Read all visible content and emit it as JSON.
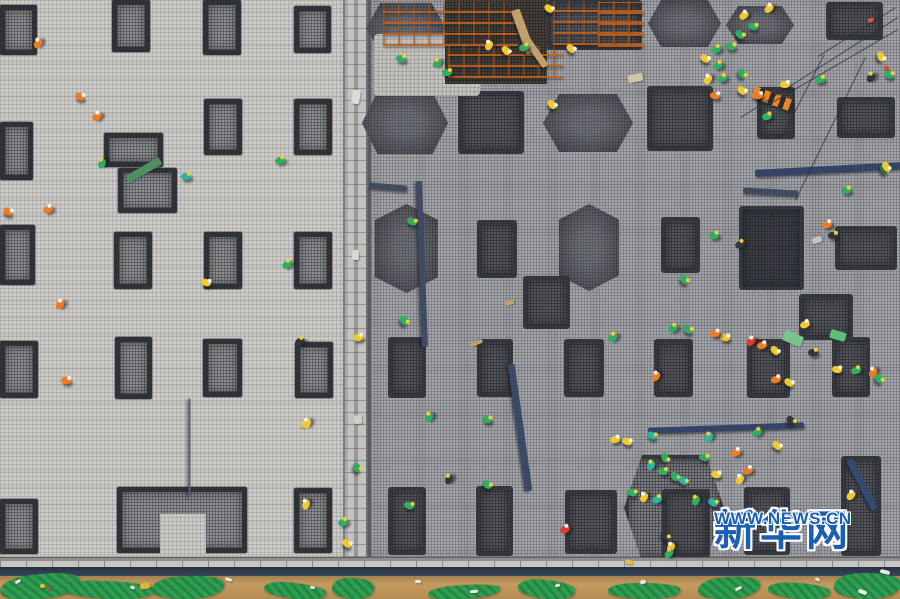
{
  "watermark": {
    "brand": "新华网",
    "url": "WWW.NEWS.CN",
    "color": "#1b5fb5"
  },
  "palette": {
    "slab_left": "#cbcac6",
    "slab_right": "#a4a5a9",
    "footing_dark": "#33363c",
    "rebar_orange": "#be5f1e",
    "steel_blue": "#3a4a66",
    "dirt": "#c59a5f",
    "tarp_green": "#2e9e50",
    "vest_green": "#2fae62",
    "vest_yellow": "#efc92e",
    "vest_orange": "#ef7b22",
    "vest_red": "#d9402a"
  },
  "left_slab": {
    "footings": [
      [
        0,
        5,
        37,
        50
      ],
      [
        112,
        0,
        38,
        52
      ],
      [
        203,
        0,
        38,
        55
      ],
      [
        294,
        6,
        37,
        47
      ],
      [
        0,
        122,
        33,
        58
      ],
      [
        204,
        99,
        38,
        56
      ],
      [
        294,
        99,
        38,
        56
      ],
      [
        104,
        133,
        59,
        34
      ],
      [
        118,
        168,
        59,
        45
      ],
      [
        0,
        225,
        35,
        60
      ],
      [
        114,
        232,
        38,
        57
      ],
      [
        204,
        232,
        38,
        57
      ],
      [
        294,
        232,
        38,
        57
      ],
      [
        0,
        341,
        38,
        57
      ],
      [
        115,
        337,
        37,
        62
      ],
      [
        203,
        339,
        39,
        58
      ],
      [
        295,
        342,
        38,
        56
      ],
      [
        0,
        499,
        38,
        55
      ],
      [
        117,
        487,
        130,
        66
      ],
      [
        294,
        488,
        38,
        65
      ]
    ],
    "patches": [
      [
        160,
        514,
        46,
        40
      ]
    ]
  },
  "right_slab": {
    "footings": [
      [
        366,
        3,
        80,
        50,
        "h"
      ],
      [
        362,
        92,
        86,
        62,
        "h"
      ],
      [
        543,
        94,
        90,
        58,
        "h"
      ],
      [
        648,
        0,
        73,
        47,
        "h"
      ],
      [
        726,
        6,
        68,
        38,
        "h"
      ],
      [
        375,
        204,
        63,
        89,
        "v"
      ],
      [
        559,
        204,
        60,
        87,
        "v"
      ],
      [
        624,
        455,
        100,
        106,
        "halo"
      ],
      [
        546,
        0,
        96,
        50,
        "r"
      ],
      [
        826,
        2,
        57,
        38,
        "r"
      ],
      [
        757,
        87,
        38,
        52,
        "r"
      ],
      [
        837,
        97,
        58,
        41,
        "r"
      ],
      [
        458,
        91,
        66,
        63,
        "d"
      ],
      [
        647,
        86,
        66,
        65,
        "d"
      ],
      [
        477,
        220,
        40,
        58,
        "r"
      ],
      [
        661,
        217,
        39,
        56,
        "r"
      ],
      [
        739,
        206,
        65,
        84,
        "b"
      ],
      [
        835,
        226,
        62,
        44,
        "r"
      ],
      [
        799,
        294,
        54,
        46,
        "r"
      ],
      [
        523,
        276,
        47,
        53,
        "w"
      ],
      [
        388,
        337,
        38,
        61,
        "r"
      ],
      [
        477,
        339,
        36,
        58,
        "r"
      ],
      [
        564,
        339,
        40,
        58,
        "r"
      ],
      [
        654,
        339,
        39,
        58,
        "r"
      ],
      [
        747,
        339,
        43,
        59,
        "r"
      ],
      [
        832,
        337,
        38,
        60,
        "r"
      ],
      [
        388,
        487,
        38,
        68,
        "r"
      ],
      [
        476,
        486,
        37,
        70,
        "r"
      ],
      [
        565,
        490,
        52,
        64,
        "r"
      ],
      [
        662,
        489,
        48,
        69,
        "r"
      ],
      [
        744,
        487,
        46,
        68,
        "r"
      ],
      [
        841,
        456,
        40,
        100,
        "r"
      ]
    ],
    "patches": [
      [
        374,
        34,
        106,
        62
      ]
    ],
    "pit": [
      445,
      0,
      102,
      84
    ],
    "scaffolds": [
      [
        383,
        2,
        135,
        44
      ],
      [
        448,
        46,
        115,
        32
      ],
      [
        553,
        1,
        90,
        44
      ],
      [
        598,
        2,
        45,
        45
      ]
    ]
  },
  "beams": [
    [
      422,
      264,
      166,
      6,
      88,
      "#3e4a66"
    ],
    [
      520,
      427,
      128,
      7,
      82,
      "#3a4a66"
    ],
    [
      726,
      428,
      156,
      6,
      -2,
      "#354466"
    ],
    [
      828,
      169,
      146,
      7,
      -3,
      "#354466"
    ],
    [
      388,
      187,
      38,
      6,
      5,
      "#414b5e"
    ],
    [
      770,
      192,
      55,
      6,
      3,
      "#414b5e"
    ],
    [
      862,
      484,
      56,
      7,
      63,
      "#354a70"
    ],
    [
      523,
      31,
      46,
      9,
      70,
      "#c2a06b"
    ],
    [
      536,
      52,
      34,
      7,
      55,
      "#c2a06b"
    ],
    [
      189,
      448,
      99,
      2,
      90,
      "#596074"
    ]
  ],
  "cables": [
    [
      898,
      18,
      741,
      118
    ],
    [
      898,
      30,
      757,
      112
    ],
    [
      896,
      8,
      818,
      57
    ],
    [
      795,
      200,
      865,
      57
    ],
    [
      782,
      136,
      824,
      54
    ]
  ],
  "lift_beam": [
    752,
    93,
    42,
    12,
    20,
    "#e88820"
  ],
  "workers": [
    [
      33,
      40,
      "#ef7b22"
    ],
    [
      75,
      93,
      "#ef7b22"
    ],
    [
      92,
      113,
      "#ef7b22"
    ],
    [
      97,
      160,
      "#2fae62"
    ],
    [
      181,
      173,
      "#2ab5a0"
    ],
    [
      275,
      157,
      "#2fae62"
    ],
    [
      3,
      208,
      "#ef7b22"
    ],
    [
      43,
      206,
      "#ef7b22"
    ],
    [
      282,
      261,
      "#2fae62"
    ],
    [
      201,
      279,
      "#efc92e"
    ],
    [
      55,
      301,
      "#ef7b22"
    ],
    [
      61,
      377,
      "#ef7b22"
    ],
    [
      295,
      338,
      "#32353c"
    ],
    [
      302,
      420,
      "#efc92e"
    ],
    [
      301,
      501,
      "#efc92e"
    ],
    [
      338,
      519,
      "#2fae62"
    ],
    [
      342,
      540,
      "#efc92e"
    ],
    [
      353,
      334,
      "#efc92e"
    ],
    [
      352,
      464,
      "#2fae62"
    ],
    [
      396,
      55,
      "#2fae62"
    ],
    [
      432,
      60,
      "#2fae62"
    ],
    [
      442,
      69,
      "#2fae62"
    ],
    [
      484,
      42,
      "#efc92e"
    ],
    [
      501,
      47,
      "#efc92e"
    ],
    [
      519,
      44,
      "#2fae62"
    ],
    [
      544,
      5,
      "#efc92e"
    ],
    [
      566,
      45,
      "#efc92e"
    ],
    [
      547,
      101,
      "#efc92e"
    ],
    [
      407,
      218,
      "#2fae62"
    ],
    [
      739,
      12,
      "#efc92e"
    ],
    [
      748,
      23,
      "#2fae62"
    ],
    [
      735,
      31,
      "#2fae62"
    ],
    [
      711,
      46,
      "#2fae62"
    ],
    [
      700,
      55,
      "#efc92e"
    ],
    [
      726,
      43,
      "#2fae62"
    ],
    [
      713,
      62,
      "#2fae62"
    ],
    [
      737,
      70,
      "#2fae62"
    ],
    [
      703,
      76,
      "#efc92e"
    ],
    [
      764,
      5,
      "#efc92e"
    ],
    [
      717,
      75,
      "#2fae62"
    ],
    [
      710,
      92,
      "#ef7b22"
    ],
    [
      753,
      92,
      "#ef7b22"
    ],
    [
      815,
      76,
      "#2fae62"
    ],
    [
      876,
      53,
      "#efc92e"
    ],
    [
      866,
      74,
      "#32353c"
    ],
    [
      884,
      71,
      "#2fae62"
    ],
    [
      780,
      81,
      "#efc92e"
    ],
    [
      737,
      87,
      "#efc92e"
    ],
    [
      762,
      113,
      "#2fae62"
    ],
    [
      709,
      232,
      "#2fae62"
    ],
    [
      735,
      241,
      "#32353c"
    ],
    [
      822,
      221,
      "#ef7b22"
    ],
    [
      828,
      232,
      "#32353c"
    ],
    [
      679,
      276,
      "#2fae62"
    ],
    [
      683,
      326,
      "#2fae62"
    ],
    [
      720,
      334,
      "#efc92e"
    ],
    [
      746,
      338,
      "#d9402a"
    ],
    [
      757,
      342,
      "#ef7b22"
    ],
    [
      800,
      321,
      "#efc92e"
    ],
    [
      868,
      369,
      "#ef7b22"
    ],
    [
      874,
      375,
      "#2fae62"
    ],
    [
      784,
      379,
      "#efc92e"
    ],
    [
      651,
      373,
      "#ef7b22"
    ],
    [
      608,
      334,
      "#2fae62"
    ],
    [
      668,
      325,
      "#2fae62"
    ],
    [
      710,
      330,
      "#ef7b22"
    ],
    [
      770,
      347,
      "#efc92e"
    ],
    [
      808,
      349,
      "#32353c"
    ],
    [
      832,
      366,
      "#efc92e"
    ],
    [
      851,
      367,
      "#2fae62"
    ],
    [
      771,
      376,
      "#ef7b22"
    ],
    [
      786,
      417,
      "#32353c"
    ],
    [
      752,
      429,
      "#2fae62"
    ],
    [
      704,
      434,
      "#2ab5a0"
    ],
    [
      660,
      454,
      "#2fae62"
    ],
    [
      646,
      462,
      "#2ab5a0"
    ],
    [
      670,
      473,
      "#2fae62"
    ],
    [
      691,
      497,
      "#2fae62"
    ],
    [
      627,
      489,
      "#2fae62"
    ],
    [
      772,
      442,
      "#efc92e"
    ],
    [
      399,
      317,
      "#2fae62"
    ],
    [
      424,
      414,
      "#2fae62"
    ],
    [
      482,
      416,
      "#2fae62"
    ],
    [
      444,
      476,
      "#32353c"
    ],
    [
      482,
      481,
      "#2fae62"
    ],
    [
      404,
      502,
      "#2fae62"
    ],
    [
      560,
      526,
      "#d9402a"
    ],
    [
      610,
      436,
      "#efc92e"
    ],
    [
      622,
      438,
      "#efc92e"
    ],
    [
      647,
      432,
      "#2ab5a0"
    ],
    [
      699,
      454,
      "#2fae62"
    ],
    [
      731,
      449,
      "#ef7b22"
    ],
    [
      743,
      467,
      "#ef7b22"
    ],
    [
      735,
      476,
      "#efc92e"
    ],
    [
      658,
      468,
      "#2fae62"
    ],
    [
      678,
      477,
      "#2ab5a0"
    ],
    [
      711,
      471,
      "#efc92e"
    ],
    [
      639,
      494,
      "#efc92e"
    ],
    [
      652,
      496,
      "#2ab5a0"
    ],
    [
      666,
      544,
      "#efc92e"
    ],
    [
      708,
      499,
      "#2ab5a0"
    ],
    [
      660,
      532,
      "#32353c"
    ],
    [
      879,
      166,
      "#2fae62"
    ],
    [
      841,
      187,
      "#2fae62"
    ],
    [
      881,
      163,
      "#efc92e"
    ],
    [
      846,
      492,
      "#efc92e"
    ],
    [
      664,
      550,
      "#2fae62"
    ]
  ],
  "debris": [
    [
      125,
      166,
      38,
      8,
      "#4e8f60"
    ],
    [
      783,
      333,
      20,
      11,
      "#79c48c"
    ],
    [
      830,
      331,
      16,
      9,
      "#5bbf77"
    ],
    [
      352,
      90,
      8,
      14,
      "#dcdcd6"
    ],
    [
      352,
      250,
      7,
      10,
      "#d8d8d2"
    ],
    [
      354,
      415,
      8,
      9,
      "#cfcfc9"
    ],
    [
      628,
      74,
      15,
      8,
      "#cfc3a8"
    ],
    [
      812,
      237,
      10,
      6,
      "#c4c4c2"
    ],
    [
      868,
      18,
      6,
      4,
      "#e0552e"
    ],
    [
      884,
      66,
      5,
      4,
      "#e0452e"
    ],
    [
      300,
      424,
      6,
      4,
      "#e6c53a"
    ],
    [
      625,
      560,
      8,
      4,
      "#e8c23a"
    ],
    [
      40,
      584,
      5,
      4,
      "#e3bf3a"
    ],
    [
      47,
      587,
      4,
      3,
      "#d4452f"
    ],
    [
      140,
      583,
      10,
      6,
      "#d8b93c"
    ],
    [
      505,
      300,
      9,
      5,
      "#c0a26a"
    ],
    [
      470,
      341,
      13,
      4,
      "#c0a26a"
    ],
    [
      15,
      580,
      6,
      3,
      "#e7e6e2"
    ],
    [
      130,
      586,
      5,
      3,
      "#e7e6e2"
    ],
    [
      225,
      578,
      7,
      3,
      "#eceae6"
    ],
    [
      310,
      586,
      5,
      3,
      "#e7e6e2"
    ],
    [
      415,
      580,
      6,
      3,
      "#eae8e4"
    ],
    [
      470,
      590,
      8,
      3,
      "#e7e6e2"
    ],
    [
      555,
      584,
      5,
      3,
      "#eae8e4"
    ],
    [
      640,
      580,
      6,
      4,
      "#e7e6e2"
    ],
    [
      735,
      587,
      7,
      3,
      "#eae8e4"
    ],
    [
      815,
      578,
      5,
      3,
      "#e7e6e2"
    ],
    [
      858,
      590,
      9,
      4,
      "#eceae6"
    ],
    [
      880,
      570,
      10,
      4,
      "#e7e6e2"
    ]
  ],
  "ground_tarps": [
    [
      0,
      574,
      80,
      25
    ],
    [
      62,
      581,
      92,
      18
    ],
    [
      152,
      576,
      72,
      23
    ],
    [
      264,
      583,
      62,
      16
    ],
    [
      332,
      578,
      42,
      21
    ],
    [
      428,
      585,
      72,
      14
    ],
    [
      518,
      580,
      57,
      19
    ],
    [
      608,
      583,
      72,
      16
    ],
    [
      698,
      577,
      62,
      22
    ],
    [
      768,
      583,
      62,
      16
    ],
    [
      834,
      573,
      66,
      26
    ]
  ]
}
